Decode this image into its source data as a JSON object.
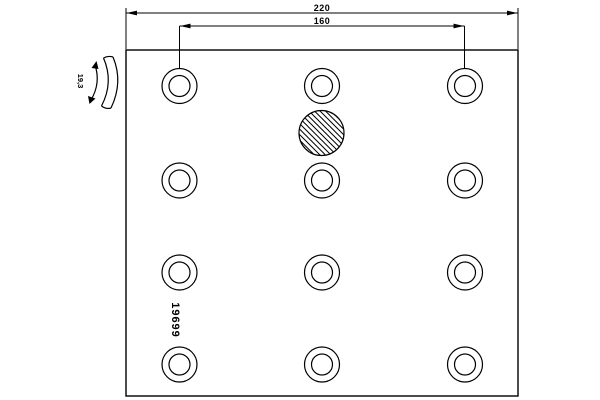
{
  "drawing_title": "brake-lining-plate-drawing",
  "part_number": "19699",
  "dimensions": {
    "overall_length_label": "220",
    "hole_spacing_label": "160",
    "thickness_label": "19,3"
  },
  "colors": {
    "line": "#000000",
    "background": "#ffffff"
  },
  "drawing": {
    "plate": {
      "x": 126,
      "y": 50,
      "width": 392,
      "height": 346
    },
    "hole_columns_x": [
      179.5,
      322,
      465
    ],
    "hole_rows_y": [
      86,
      180.5,
      272.5,
      364.5
    ],
    "hole_outer_radius": 17.5,
    "hole_inner_radius": 10.5,
    "hatched_circle": {
      "cx": 321.5,
      "cy": 133,
      "r": 22.5
    },
    "hole_count": 12,
    "grid": {
      "columns": 3,
      "rows": 4
    }
  }
}
